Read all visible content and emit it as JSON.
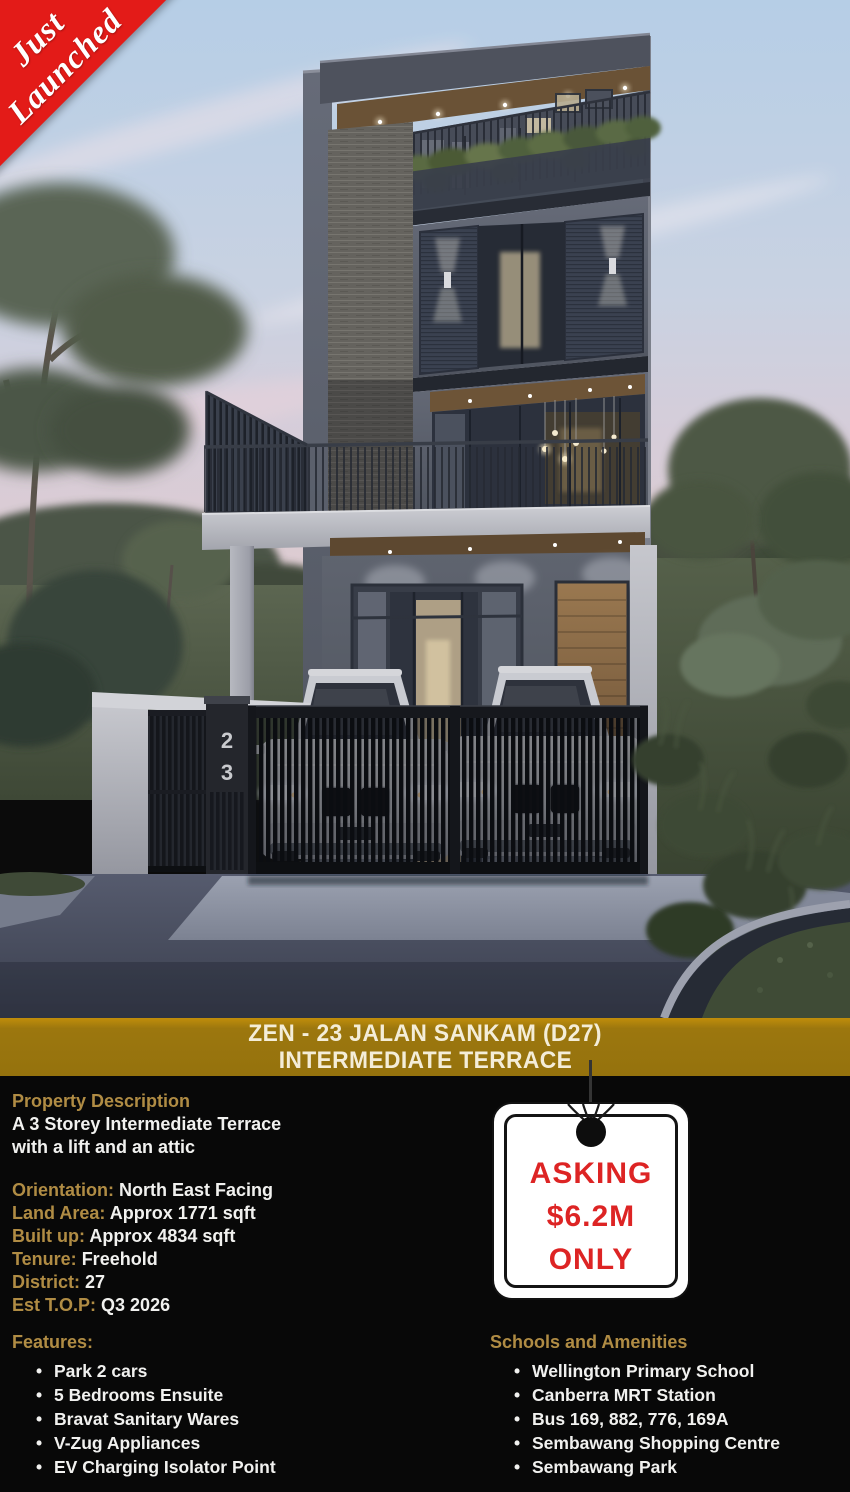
{
  "ribbon": {
    "line1": "Just",
    "line2": "Launched"
  },
  "photo": {
    "description": "dusk rendering of 3-storey modern terrace house with two white cars behind black slatted gate",
    "house_number": {
      "digit1": "2",
      "digit2": "3"
    }
  },
  "banner": {
    "line1": "ZEN - 23 JALAN SANKAM (D27)",
    "line2": "INTERMEDIATE TERRACE"
  },
  "details": {
    "description_heading": "Property Description",
    "description_lines": [
      "A 3 Storey Intermediate Terrace",
      "with a lift and an attic"
    ],
    "specs": [
      {
        "label": "Orientation:",
        "value": "North East Facing"
      },
      {
        "label": "Land Area:",
        "value": "Approx 1771 sqft"
      },
      {
        "label": "Built up:",
        "value": "Approx 4834 sqft"
      },
      {
        "label": "Tenure:",
        "value": "Freehold"
      },
      {
        "label": "District:",
        "value": "27"
      },
      {
        "label": "Est T.O.P:",
        "value": "Q3 2026"
      }
    ],
    "features": {
      "heading": "Features:",
      "items": [
        "Park 2 cars",
        "5 Bedrooms Ensuite",
        "Bravat Sanitary Wares",
        "V-Zug Appliances",
        "EV Charging Isolator Point"
      ]
    },
    "amenities": {
      "heading": "Schools and Amenities",
      "items": [
        "Wellington Primary School",
        "Canberra MRT Station",
        "Bus 169, 882, 776, 169A",
        "Sembawang Shopping Centre",
        "Sembawang Park"
      ]
    }
  },
  "price_tag": {
    "line1": "ASKING",
    "line2": "$6.2M",
    "line3": "ONLY"
  },
  "bullet": "•",
  "colors": {
    "ribbon_red": "#e31b18",
    "banner_gold": "#9c770e",
    "accent_gold": "#b08c44",
    "price_red": "#dd2424",
    "section_bg": "#080808",
    "body_text": "#f1f1ef"
  }
}
